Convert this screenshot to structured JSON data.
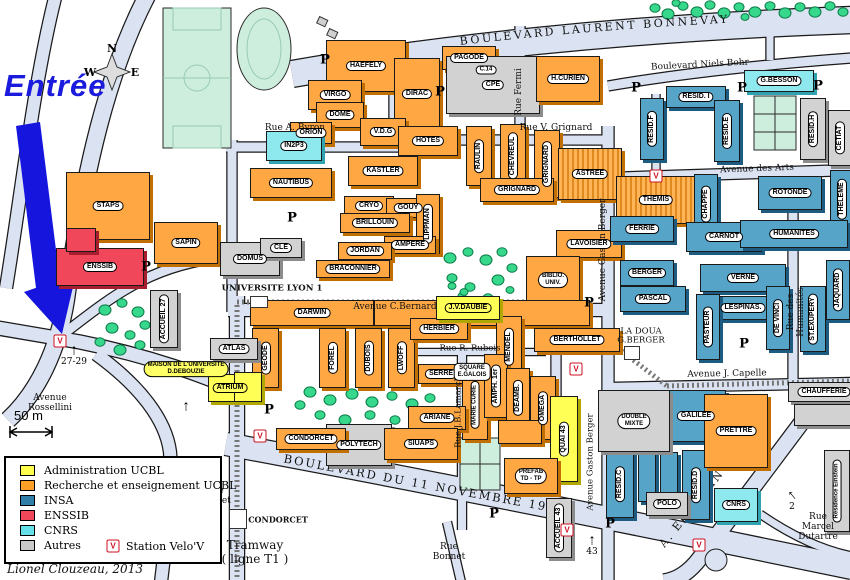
{
  "map_title": {
    "entrance_label": "Entrée",
    "credit": "Lionel Clouzeau, 2013",
    "tramway_note": "Tramway\n( ligne T1 )",
    "scale_label": "50 m"
  },
  "compass": {
    "n": "N",
    "w": "W",
    "e": "E"
  },
  "symbols": {
    "parking": "P",
    "velov": "V",
    "up_arrow": "↑"
  },
  "legend": {
    "items": [
      {
        "label": "Administration UCBL",
        "color": "#ffff4d"
      },
      {
        "label": "Recherche et enseignement UCBL",
        "color": "#ffa126"
      },
      {
        "label": "INSA",
        "color": "#2f7fa8"
      },
      {
        "label": "ENSSIB",
        "color": "#f0485a"
      },
      {
        "label": "CNRS",
        "color": "#66e0e8"
      },
      {
        "label": "Autres",
        "color": "#c9c9c9"
      }
    ],
    "velov_label": "Station Velo'V"
  },
  "streets_svg": {
    "bonnevay": "BOULEVARD  LAURENT  BONNEVAY",
    "blvd11": "BOULEVARD  DU  11  NOVEMBRE  1918",
    "einstein": "A. EINSTEIN"
  },
  "streets": [
    {
      "t": "Boulevard  Niels  Bohr",
      "x": 700,
      "y": 66,
      "r": -3,
      "s": 9
    },
    {
      "t": "Rue Fermi",
      "x": 520,
      "y": 92,
      "r": -90,
      "s": 9
    },
    {
      "t": "Rue A. Byron",
      "x": 295,
      "y": 129,
      "r": 0,
      "s": 9
    },
    {
      "t": "Rue V. Grignard",
      "x": 556,
      "y": 129,
      "r": 0,
      "s": 9
    },
    {
      "t": "Avenue des Arts",
      "x": 757,
      "y": 170,
      "r": -2,
      "s": 9
    },
    {
      "t": "Avenue Gaston Berger",
      "x": 604,
      "y": 250,
      "r": -90,
      "s": 9
    },
    {
      "t": "Rue des Humanités",
      "x": 797,
      "y": 312,
      "r": -90,
      "s": 9
    },
    {
      "t": "Avenue J. Capelle",
      "x": 727,
      "y": 375,
      "r": -1,
      "s": 9
    },
    {
      "t": "Rue R. Rubois",
      "x": 470,
      "y": 349,
      "r": 0,
      "s": 8.5
    },
    {
      "t": "Rue J.B.Lamarck",
      "x": 459,
      "y": 412,
      "r": -90,
      "s": 8.5
    },
    {
      "t": "Avenue Gaston Berger",
      "x": 591,
      "y": 462,
      "r": -90,
      "s": 8.5
    },
    {
      "t": "Avenue C.Bernard",
      "x": 395,
      "y": 308,
      "r": 0,
      "s": 9
    },
    {
      "t": "UNIVERSITE LYON 1",
      "x": 272,
      "y": 289,
      "r": 0,
      "s": 8.5,
      "b": 1
    },
    {
      "t": "Avenue\nRossellini",
      "x": 50,
      "y": 404,
      "r": 0,
      "s": 9
    },
    {
      "t": "Rue du\nTonkin",
      "x": 162,
      "y": 470,
      "r": 0,
      "s": 9
    },
    {
      "t": "Avenue\nCondorcet",
      "x": 207,
      "y": 497,
      "r": 0,
      "s": 9
    },
    {
      "t": "CONDORCET",
      "x": 278,
      "y": 520,
      "r": 0,
      "s": 8,
      "b": 1
    },
    {
      "t": "Rue\nBonnet",
      "x": 449,
      "y": 553,
      "r": 0,
      "s": 9
    },
    {
      "t": "Rue Marcel\nDutartre",
      "x": 818,
      "y": 528,
      "r": 0,
      "s": 9
    },
    {
      "t": "LA DOUA\nG.BERGER",
      "x": 641,
      "y": 337,
      "r": 0,
      "s": 8.5
    }
  ],
  "buildings": [
    {
      "l": "STAPS",
      "c": "o",
      "x": 66,
      "y": 172,
      "w": 84,
      "h": 68
    },
    {
      "l": "SAPIN",
      "c": "o",
      "x": 154,
      "y": 222,
      "w": 64,
      "h": 42
    },
    {
      "l": "ENSSIB",
      "c": "r",
      "x": 56,
      "y": 248,
      "w": 88,
      "h": 38
    },
    {
      "l": "",
      "c": "r",
      "x": 66,
      "y": 228,
      "w": 30,
      "h": 24
    },
    {
      "l": "HAEFELY",
      "c": "o",
      "x": 326,
      "y": 40,
      "w": 80,
      "h": 52
    },
    {
      "l": "VIRGO",
      "c": "o",
      "x": 308,
      "y": 80,
      "w": 54,
      "h": 30
    },
    {
      "l": "DOME",
      "c": "o",
      "x": 316,
      "y": 102,
      "w": 48,
      "h": 26
    },
    {
      "l": "DIRAC",
      "c": "o",
      "x": 394,
      "y": 58,
      "w": 46,
      "h": 72
    },
    {
      "l": "PAGODE",
      "c": "o",
      "x": 442,
      "y": 46,
      "w": 54,
      "h": 24
    },
    {
      "l": "C.14",
      "c": "o",
      "x": 474,
      "y": 62,
      "w": 24,
      "h": 16,
      "fs": 6
    },
    {
      "l": "CPE",
      "c": "g",
      "x": 446,
      "y": 56,
      "w": 94,
      "h": 58
    },
    {
      "l": "H.CURIEN",
      "c": "o",
      "x": 536,
      "y": 56,
      "w": 64,
      "h": 46
    },
    {
      "l": "ORION",
      "c": "o",
      "x": 290,
      "y": 122,
      "w": 42,
      "h": 22
    },
    {
      "l": "V.D.G",
      "c": "o",
      "x": 360,
      "y": 118,
      "w": 46,
      "h": 28
    },
    {
      "l": "HOTES",
      "c": "o",
      "x": 398,
      "y": 126,
      "w": 60,
      "h": 30
    },
    {
      "l": "IN2P3",
      "c": "c",
      "x": 266,
      "y": 131,
      "w": 56,
      "h": 30
    },
    {
      "l": "NAUTIBUS",
      "c": "o",
      "x": 250,
      "y": 168,
      "w": 82,
      "h": 30
    },
    {
      "l": "KASTLER",
      "c": "o",
      "x": 348,
      "y": 156,
      "w": 70,
      "h": 30
    },
    {
      "l": "CRYO",
      "c": "o",
      "x": 344,
      "y": 196,
      "w": 50,
      "h": 20
    },
    {
      "l": "GOUY",
      "c": "o",
      "x": 386,
      "y": 198,
      "w": 44,
      "h": 20
    },
    {
      "l": "BRILLOUIN",
      "c": "o",
      "x": 340,
      "y": 213,
      "w": 70,
      "h": 20
    },
    {
      "l": "LIPPMAN",
      "c": "o",
      "v": 1,
      "x": 416,
      "y": 194,
      "w": 24,
      "h": 60
    },
    {
      "l": "AMPERE",
      "c": "o",
      "x": 384,
      "y": 236,
      "w": 52,
      "h": 18
    },
    {
      "l": "JORDAN",
      "c": "o",
      "x": 338,
      "y": 242,
      "w": 54,
      "h": 18
    },
    {
      "l": "BRACONNIER",
      "c": "o",
      "x": 316,
      "y": 260,
      "w": 74,
      "h": 18
    },
    {
      "l": "RAULIN",
      "c": "o",
      "v": 1,
      "x": 466,
      "y": 126,
      "w": 26,
      "h": 60
    },
    {
      "l": "CHEVREUL",
      "c": "o",
      "v": 1,
      "x": 500,
      "y": 124,
      "w": 26,
      "h": 64
    },
    {
      "l": "GRIGNARD",
      "c": "o",
      "v": 1,
      "x": 534,
      "y": 130,
      "w": 26,
      "h": 68
    },
    {
      "l": "GRIGNARD",
      "c": "o",
      "x": 480,
      "y": 178,
      "w": 74,
      "h": 24
    },
    {
      "l": "ASTREE",
      "c": "t",
      "x": 558,
      "y": 148,
      "w": 64,
      "h": 52
    },
    {
      "l": "THEMIS",
      "c": "t",
      "x": 616,
      "y": 176,
      "w": 80,
      "h": 48
    },
    {
      "l": "LAVOISIER",
      "c": "o",
      "x": 556,
      "y": 230,
      "w": 66,
      "h": 28
    },
    {
      "l": "BIBLIO.",
      "l2": "UNIV.",
      "c": "o",
      "x": 526,
      "y": 256,
      "w": 54,
      "h": 48
    },
    {
      "l": "DARWIN",
      "c": "o",
      "x": 250,
      "y": 300,
      "w": 124,
      "h": 26
    },
    {
      "l": "",
      "c": "o",
      "x": 374,
      "y": 300,
      "w": 216,
      "h": 26
    },
    {
      "l": "GEODE",
      "c": "o",
      "v": 1,
      "x": 252,
      "y": 328,
      "w": 27,
      "h": 60
    },
    {
      "l": "FOREL",
      "c": "o",
      "v": 1,
      "x": 319,
      "y": 328,
      "w": 27,
      "h": 60
    },
    {
      "l": "DUBOIS",
      "c": "o",
      "v": 1,
      "x": 355,
      "y": 328,
      "w": 27,
      "h": 60
    },
    {
      "l": "LWOFF",
      "c": "o",
      "v": 1,
      "x": 388,
      "y": 328,
      "w": 27,
      "h": 60
    },
    {
      "l": "HERBIER",
      "c": "o",
      "x": 410,
      "y": 318,
      "w": 58,
      "h": 22
    },
    {
      "l": "SERRE",
      "c": "o",
      "x": 418,
      "y": 364,
      "w": 46,
      "h": 20
    },
    {
      "l": "MENDEL",
      "c": "o",
      "v": 1,
      "x": 496,
      "y": 316,
      "w": 26,
      "h": 62
    },
    {
      "l": "BERTHOLLET",
      "c": "o",
      "x": 534,
      "y": 328,
      "w": 86,
      "h": 24
    },
    {
      "l": "MARIE CURIE",
      "c": "o",
      "v": 1,
      "x": 462,
      "y": 370,
      "w": 26,
      "h": 70
    },
    {
      "l": "AMPH. 1er",
      "c": "o",
      "v": 1,
      "x": 484,
      "y": 354,
      "w": 24,
      "h": 64
    },
    {
      "l": "DEAMB.",
      "c": "o",
      "v": 1,
      "x": 506,
      "y": 368,
      "w": 24,
      "h": 60
    },
    {
      "l": "OMEGA",
      "c": "o",
      "v": 1,
      "x": 530,
      "y": 376,
      "w": 26,
      "h": 64
    },
    {
      "l": "ARIANE",
      "c": "o",
      "x": 408,
      "y": 406,
      "w": 58,
      "h": 24
    },
    {
      "l": "J.V.DAUBIE",
      "c": "y",
      "lb": "y",
      "x": 436,
      "y": 296,
      "w": 64,
      "h": 24
    },
    {
      "l": "ATRIUM",
      "c": "y",
      "lb": "y",
      "x": 208,
      "y": 374,
      "w": 44,
      "h": 28
    },
    {
      "l": "QUAI 43",
      "c": "y",
      "v": 1,
      "x": 550,
      "y": 396,
      "w": 28,
      "h": 86
    },
    {
      "l": "MAISON DE L'UNIVERSITE",
      "l2": "D.DEBOUZIE",
      "c": "none",
      "lb": "y",
      "x": 130,
      "y": 356,
      "w": 112,
      "h": 26
    },
    {
      "l": "",
      "c": "y",
      "x": 234,
      "y": 372,
      "w": 28,
      "h": 30
    },
    {
      "l": "RESID.F",
      "c": "b",
      "v": 1,
      "x": 640,
      "y": 98,
      "w": 24,
      "h": 62
    },
    {
      "l": "RESID. I",
      "c": "b",
      "x": 666,
      "y": 86,
      "w": 60,
      "h": 22
    },
    {
      "l": "RESID.E",
      "c": "b",
      "v": 1,
      "x": 714,
      "y": 100,
      "w": 26,
      "h": 62
    },
    {
      "l": "FERRIE",
      "c": "b",
      "x": 610,
      "y": 216,
      "w": 64,
      "h": 26
    },
    {
      "l": "CHAPPE",
      "c": "b",
      "v": 1,
      "x": 694,
      "y": 174,
      "w": 24,
      "h": 60
    },
    {
      "l": "CARNOT",
      "c": "b",
      "x": 686,
      "y": 222,
      "w": 76,
      "h": 30
    },
    {
      "l": "ROTONDE",
      "c": "b",
      "x": 758,
      "y": 176,
      "w": 64,
      "h": 34
    },
    {
      "l": "THELEME",
      "c": "b",
      "v": 1,
      "x": 830,
      "y": 170,
      "w": 24,
      "h": 58
    },
    {
      "l": "HUMANITES",
      "c": "b",
      "x": 740,
      "y": 220,
      "w": 108,
      "h": 28
    },
    {
      "l": "BERGER",
      "c": "b",
      "x": 620,
      "y": 260,
      "w": 54,
      "h": 26
    },
    {
      "l": "VERNE",
      "c": "b",
      "x": 700,
      "y": 264,
      "w": 86,
      "h": 28
    },
    {
      "l": "PASCAL",
      "c": "b",
      "x": 620,
      "y": 286,
      "w": 66,
      "h": 26
    },
    {
      "l": "LESPINAS.",
      "c": "b",
      "x": 712,
      "y": 296,
      "w": 62,
      "h": 24
    },
    {
      "l": "PASTEUR",
      "c": "b",
      "v": 1,
      "x": 696,
      "y": 294,
      "w": 24,
      "h": 66
    },
    {
      "l": "DE VINCI",
      "c": "b",
      "v": 1,
      "x": 766,
      "y": 286,
      "w": 24,
      "h": 64
    },
    {
      "l": "ST.EXUPERY",
      "c": "b",
      "v": 1,
      "x": 800,
      "y": 286,
      "w": 26,
      "h": 66
    },
    {
      "l": "JAQUARD",
      "c": "b",
      "v": 1,
      "x": 826,
      "y": 260,
      "w": 24,
      "h": 60
    },
    {
      "l": "GALILEE",
      "c": "b",
      "x": 666,
      "y": 390,
      "w": 60,
      "h": 52
    },
    {
      "l": "RESID.C",
      "c": "b",
      "v": 1,
      "x": 606,
      "y": 450,
      "w": 28,
      "h": 68
    },
    {
      "l": "RESID.D",
      "c": "b",
      "v": 1,
      "x": 682,
      "y": 450,
      "w": 28,
      "h": 70
    },
    {
      "l": "",
      "c": "b",
      "x": 638,
      "y": 452,
      "w": 18,
      "h": 50
    },
    {
      "l": "",
      "c": "b",
      "x": 660,
      "y": 452,
      "w": 18,
      "h": 50
    },
    {
      "l": "G.BESSON",
      "c": "c",
      "x": 744,
      "y": 70,
      "w": 70,
      "h": 22
    },
    {
      "l": "CNRS",
      "c": "c",
      "x": 714,
      "y": 488,
      "w": 44,
      "h": 34
    },
    {
      "l": "DOMUS",
      "c": "g",
      "x": 220,
      "y": 242,
      "w": 60,
      "h": 34
    },
    {
      "l": "CLE",
      "c": "g",
      "x": 260,
      "y": 238,
      "w": 42,
      "h": 20
    },
    {
      "l": "ATLAS",
      "c": "g",
      "x": 210,
      "y": 338,
      "w": 48,
      "h": 22
    },
    {
      "l": "ACCUEIL 27",
      "c": "g",
      "v": 1,
      "x": 150,
      "y": 290,
      "w": 28,
      "h": 58
    },
    {
      "l": "POLYTECH",
      "c": "g",
      "x": 326,
      "y": 424,
      "w": 66,
      "h": 42
    },
    {
      "l": "DOUBLE",
      "l2": "MIXTE",
      "c": "g",
      "x": 598,
      "y": 390,
      "w": 72,
      "h": 62
    },
    {
      "l": "POLO",
      "c": "g",
      "x": 646,
      "y": 492,
      "w": 42,
      "h": 24
    },
    {
      "l": "ACCUEIL 43",
      "c": "g",
      "v": 1,
      "x": 546,
      "y": 498,
      "w": 26,
      "h": 60
    },
    {
      "l": "RESID.H",
      "c": "g",
      "v": 1,
      "x": 800,
      "y": 98,
      "w": 26,
      "h": 62
    },
    {
      "l": "CETIAT",
      "c": "g",
      "v": 1,
      "x": 828,
      "y": 110,
      "w": 24,
      "h": 56
    },
    {
      "l": "CHAUFFERIE",
      "c": "g",
      "x": 788,
      "y": 382,
      "w": 72,
      "h": 20
    },
    {
      "l": "",
      "c": "g",
      "x": 794,
      "y": 404,
      "w": 58,
      "h": 22
    },
    {
      "l": "Résidence Einstein",
      "c": "g",
      "v": 1,
      "x": 824,
      "y": 450,
      "w": 26,
      "h": 82,
      "fs": 6
    },
    {
      "l": "CONDORCET",
      "c": "o",
      "x": 276,
      "y": 428,
      "w": 70,
      "h": 22
    },
    {
      "l": "SIUAPS",
      "c": "o",
      "x": 384,
      "y": 428,
      "w": 74,
      "h": 32
    },
    {
      "l": "PREFAB",
      "l2": "TD - TP",
      "c": "o",
      "x": 504,
      "y": 458,
      "w": 54,
      "h": 36
    },
    {
      "l": "",
      "c": "o",
      "x": 498,
      "y": 420,
      "w": 44,
      "h": 24
    },
    {
      "l": "PRETTRE",
      "c": "o",
      "x": 704,
      "y": 394,
      "w": 64,
      "h": 74
    },
    {
      "l": "SQUARE",
      "l2": "E.GALOIS",
      "c": "none",
      "x": 444,
      "y": 358,
      "w": 56,
      "h": 28
    }
  ],
  "parkings": [
    {
      "x": 325,
      "y": 60
    },
    {
      "x": 440,
      "y": 92
    },
    {
      "x": 636,
      "y": 88
    },
    {
      "x": 742,
      "y": 88
    },
    {
      "x": 818,
      "y": 86
    },
    {
      "x": 292,
      "y": 218
    },
    {
      "x": 146,
      "y": 267
    },
    {
      "x": 269,
      "y": 410
    },
    {
      "x": 589,
      "y": 303
    },
    {
      "x": 744,
      "y": 344
    },
    {
      "x": 610,
      "y": 524
    },
    {
      "x": 494,
      "y": 514
    }
  ],
  "velov_stations": [
    {
      "x": 60,
      "y": 341
    },
    {
      "x": 656,
      "y": 176
    },
    {
      "x": 576,
      "y": 369
    },
    {
      "x": 260,
      "y": 436
    },
    {
      "x": 567,
      "y": 530
    },
    {
      "x": 699,
      "y": 545
    }
  ],
  "entrance_arrows": [
    {
      "t": "27-29",
      "x": 74,
      "y": 350
    },
    {
      "t": "43",
      "x": 592,
      "y": 540
    },
    {
      "t": "2",
      "x": 792,
      "y": 495,
      "r": -40
    },
    {
      "t": "",
      "x": 186,
      "y": 406
    }
  ]
}
